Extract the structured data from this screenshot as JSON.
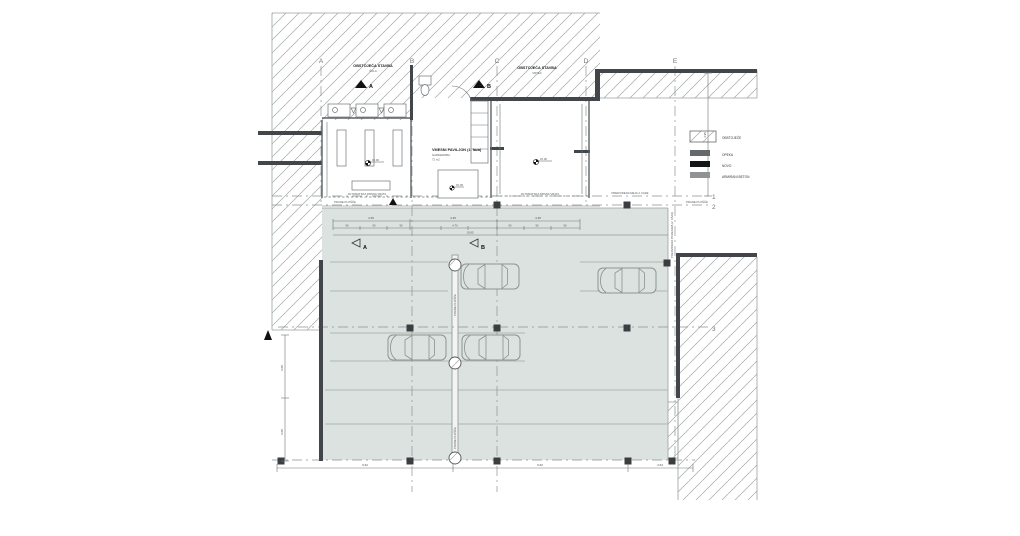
{
  "legend": {
    "items": [
      {
        "swatch": "hatch",
        "label": "OBSTOJEČE"
      },
      {
        "swatch": "darkgray",
        "label": "OPEKA"
      },
      {
        "swatch": "black",
        "label": "NOVO"
      },
      {
        "swatch": "gray",
        "label": "ARMIRANI BETON"
      }
    ],
    "colors": {
      "darkgray": "#66696b",
      "black": "#131517",
      "gray": "#909394"
    }
  },
  "grid": {
    "cols": [
      "A",
      "B",
      "C",
      "D",
      "E"
    ],
    "rows": [
      "1",
      "2",
      "3"
    ]
  },
  "labels": {
    "area1_line1": "OBSTOJEČA STAVBA",
    "area1_line2": "ŠOLA",
    "area2_line1": "OBSTOJEČA STAVBA",
    "area2_line2": "VRTEC",
    "pavilion_line1": "VMESNI PAVILJON (1. faza)",
    "pavilion_line2": "GARDEROBA",
    "pavilion_line3": "72 m2",
    "prane": "PRANE PLOŠČE",
    "reserve_vertical": "PREDVIDENA POVEZAVA (2. FAZA)",
    "reserve_horizontal": "PREDVIDENA MEJA 2. FAZE",
    "door": "AVTOMATSKA DRSNA VRATA",
    "level": "±0.00"
  },
  "sections": {
    "a": "A",
    "b": "B"
  },
  "dims": {
    "top": [
      "4.45",
      "4.45",
      "4.45"
    ],
    "top_sub": [
      "90",
      "90",
      "90",
      "4.70",
      "90",
      "90",
      "90"
    ],
    "top_total": "19.85",
    "bottom": [
      "9.62",
      "9.62",
      "3.64"
    ],
    "left": [
      "6.05",
      "6.05"
    ],
    "right": "4.95"
  },
  "plan_colors": {
    "parking_fill": "#dce2df",
    "wall": "#42464a",
    "hatch_line": "#a3a8a8"
  }
}
